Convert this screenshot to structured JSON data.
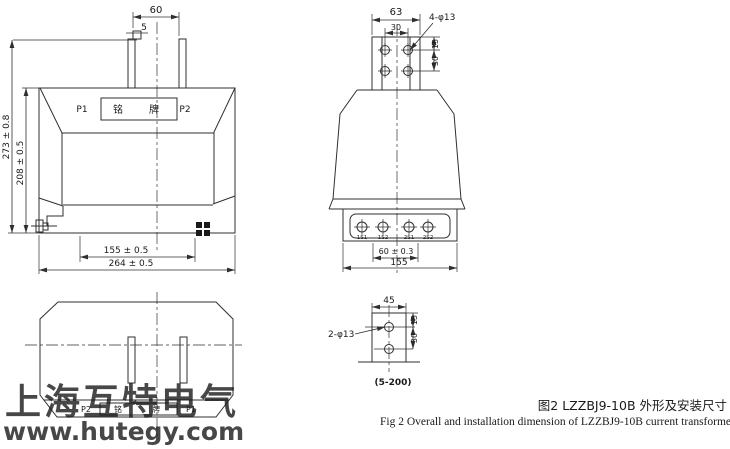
{
  "figure": {
    "front_view": {
      "dim_terminal_spacing_top": "60",
      "dim_tab_offset": "5",
      "label_p1": "P1",
      "nameplate": "铭牌",
      "label_p2": "P2",
      "dim_total_height": "273 ± 0.8",
      "dim_body_height": "208 ± 0.5",
      "dim_mount_hole_spacing": "155 ± 0.5",
      "dim_total_width": "264 ± 0.5"
    },
    "side_view": {
      "dim_plate_width": "63",
      "dim_hole_col_spacing": "30",
      "label_top_holes": "4-φ13",
      "dim_hole_top_offset": "15",
      "dim_hole_row_spacing": "30",
      "terminals": [
        "1S1",
        "1S2",
        "2S1",
        "2S2"
      ],
      "dim_secondary_spacing": "60 ± 0.3",
      "dim_base_width": "155"
    },
    "top_view": {
      "label_p2": "P2",
      "nameplate": "铭牌",
      "label_p1": "P1"
    },
    "bracket_detail": {
      "dim_width": "45",
      "label_holes": "2-φ13",
      "dim_hole_top_offset": "15",
      "dim_hole_row_spacing": "30",
      "range_note": "(5-200)"
    },
    "caption": {
      "zh": "图2 LZZBJ9-10B 外形及安装尺寸",
      "en": "Fig 2 Overall and installation dimension of LZZBJ9-10B current transformer"
    },
    "watermark": {
      "company": "上海互特电气",
      "website": "www.hutegy.com",
      "color": "#a9c6e2"
    },
    "line_color": "#2f2f2f"
  }
}
